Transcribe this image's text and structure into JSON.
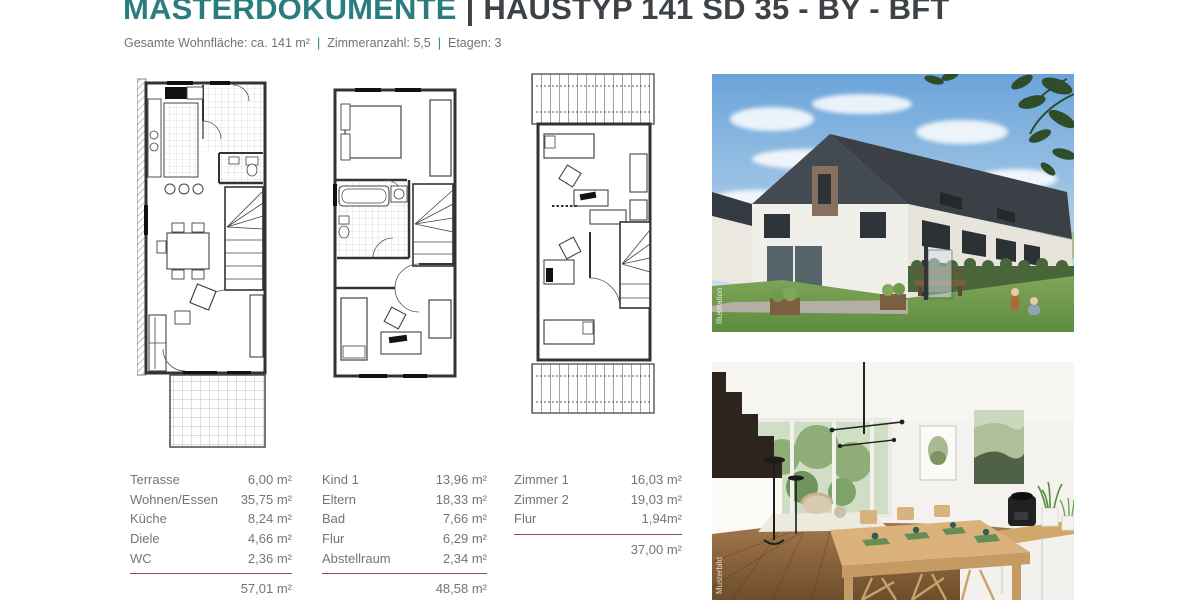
{
  "header": {
    "title": "MASTERDOKUMENTE",
    "divider": "|",
    "subtitle": "HAUSTYP 141 SD 35 - BY - BFT",
    "meta_items": [
      "Gesamte Wohnfläche: ca. 141 m²",
      "Zimmeranzahl: 5,5",
      "Etagen: 3"
    ]
  },
  "photos": {
    "exterior_watermark": "Illustration",
    "interior_watermark": "Musterbild"
  },
  "area_tables": [
    {
      "rows": [
        {
          "label": "Terrasse",
          "value": "6,00 m²"
        },
        {
          "label": "Wohnen/Essen",
          "value": "35,75 m²"
        },
        {
          "label": "Küche",
          "value": "8,24 m²"
        },
        {
          "label": "Diele",
          "value": "4,66 m²"
        },
        {
          "label": "WC",
          "value": "2,36 m²"
        }
      ],
      "total": "57,01 m²"
    },
    {
      "rows": [
        {
          "label": "Kind 1",
          "value": "13,96 m²"
        },
        {
          "label": "Eltern",
          "value": "18,33 m²"
        },
        {
          "label": "Bad",
          "value": "7,66 m²"
        },
        {
          "label": "Flur",
          "value": "6,29 m²"
        },
        {
          "label": "Abstellraum",
          "value": "2,34 m²"
        }
      ],
      "total": "48,58 m²"
    },
    {
      "rows": [
        {
          "label": "Zimmer 1",
          "value": "16,03 m²"
        },
        {
          "label": "Zimmer 2",
          "value": "19,03 m²"
        },
        {
          "label": "Flur",
          "value": "1,94m²"
        }
      ],
      "total": "37,00 m²"
    }
  ],
  "colors": {
    "accent_teal": "#2a7d7f",
    "heading_dark": "#3d4247",
    "text_gray": "#71767b",
    "rule_maroon": "#8e4a57"
  }
}
